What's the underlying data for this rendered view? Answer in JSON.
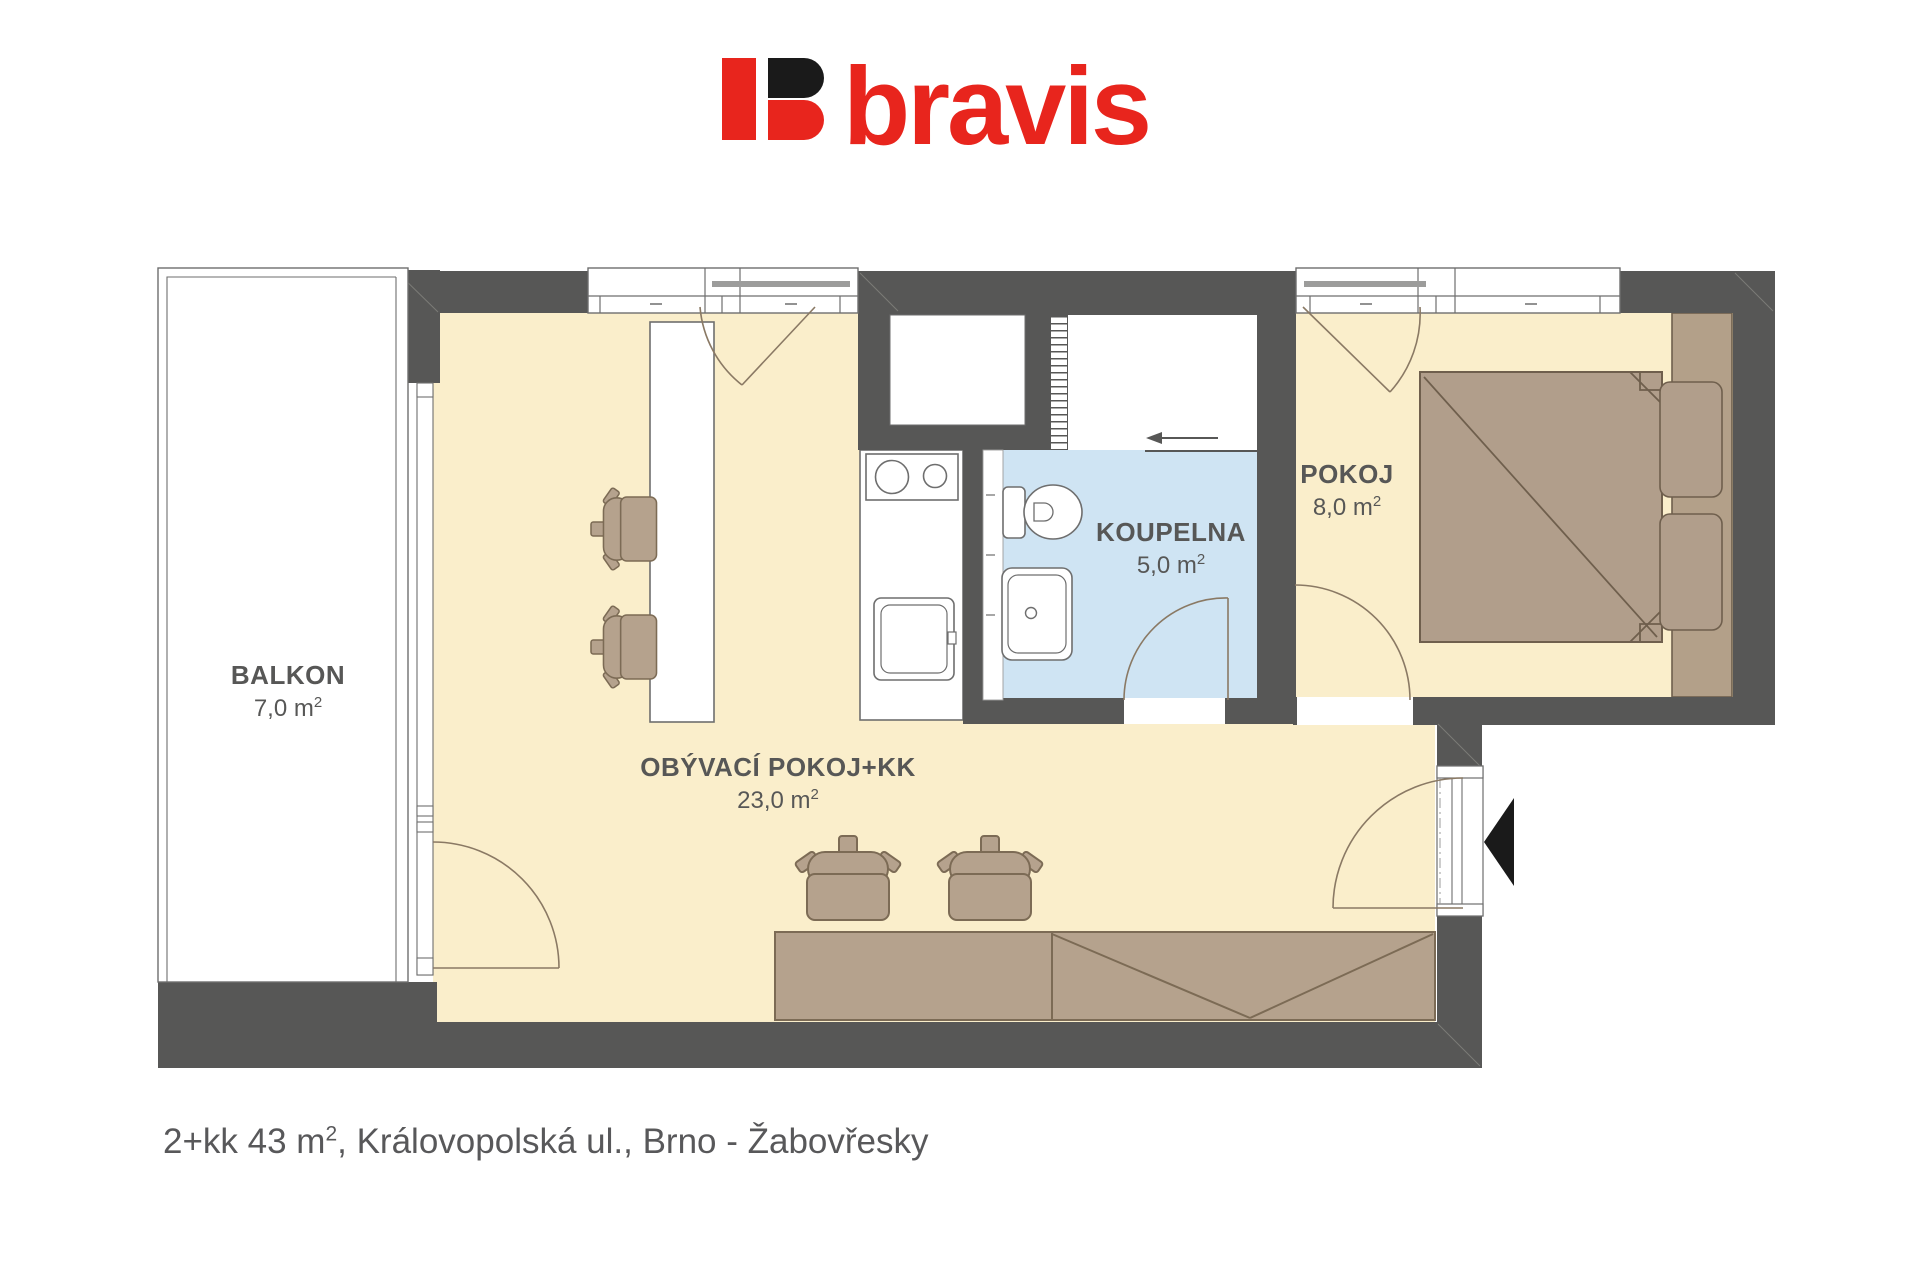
{
  "logo": {
    "brand": "bravis",
    "mark": "b-icon"
  },
  "plan": {
    "rooms": [
      {
        "name": "BALKON",
        "area_value": "7,0 m",
        "area_sup": "2"
      },
      {
        "name": "OBÝVACÍ POKOJ+KK",
        "area_value": "23,0 m",
        "area_sup": "2"
      },
      {
        "name": "KOUPELNA",
        "area_value": "5,0 m",
        "area_sup": "2"
      },
      {
        "name": "POKOJ",
        "area_value": "8,0 m",
        "area_sup": "2"
      }
    ]
  },
  "caption": {
    "part1": "2+kk 43 m",
    "sup": "2",
    "part2": ", Královopolská ul., Brno - Žabovřesky"
  },
  "colors": {
    "wall": "#575756",
    "floor": "#FAEECB",
    "bathroom_floor": "#CFE4F3",
    "furniture": "#B5A28D",
    "furniture_outline": "#7C6B55",
    "fixture_outline": "#6E6E6E",
    "logo_red": "#E8251D",
    "logo_black": "#1A1A1A",
    "text": "#575756"
  }
}
